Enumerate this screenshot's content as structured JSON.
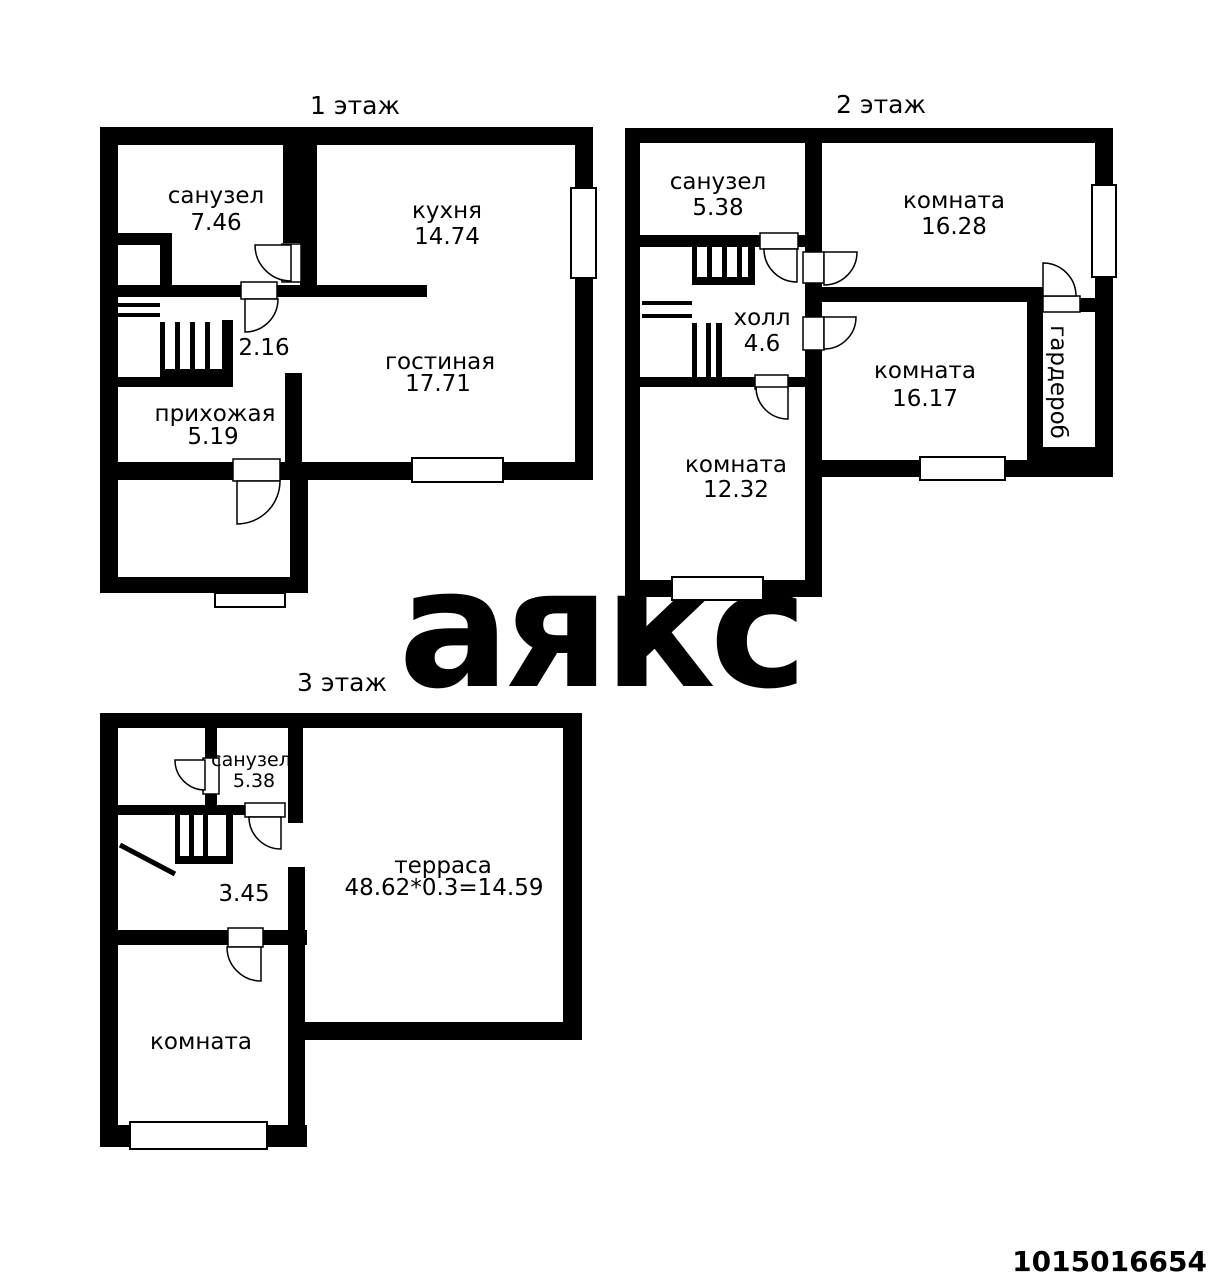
{
  "watermark": {
    "text": "аякс",
    "color": "#e9e9e9"
  },
  "listing": {
    "id": "1015016654",
    "color": "#d91414"
  },
  "plan": {
    "wall_color": "#000000",
    "background": "#ffffff"
  },
  "floors": [
    {
      "title": "1 этаж",
      "rooms": [
        {
          "name": "санузел",
          "area": "7.46"
        },
        {
          "name": "кухня",
          "area": "14.74"
        },
        {
          "name": "гостиная",
          "area": "17.71"
        },
        {
          "name": "прихожая",
          "area": "5.19"
        },
        {
          "area": "2.16"
        }
      ]
    },
    {
      "title": "2 этаж",
      "rooms": [
        {
          "name": "санузел",
          "area": "5.38"
        },
        {
          "name": "комната",
          "area": "16.28"
        },
        {
          "name": "холл",
          "area": "4.6"
        },
        {
          "name": "комната",
          "area": "16.17"
        },
        {
          "name": "гардероб"
        },
        {
          "name": "комната",
          "area": "12.32"
        }
      ]
    },
    {
      "title": "3 этаж",
      "rooms": [
        {
          "name": "санузел",
          "area": "5.38"
        },
        {
          "name": "терраса",
          "area": "48.62*0.3=14.59"
        },
        {
          "area": "3.45"
        },
        {
          "name": "комната"
        }
      ]
    }
  ]
}
